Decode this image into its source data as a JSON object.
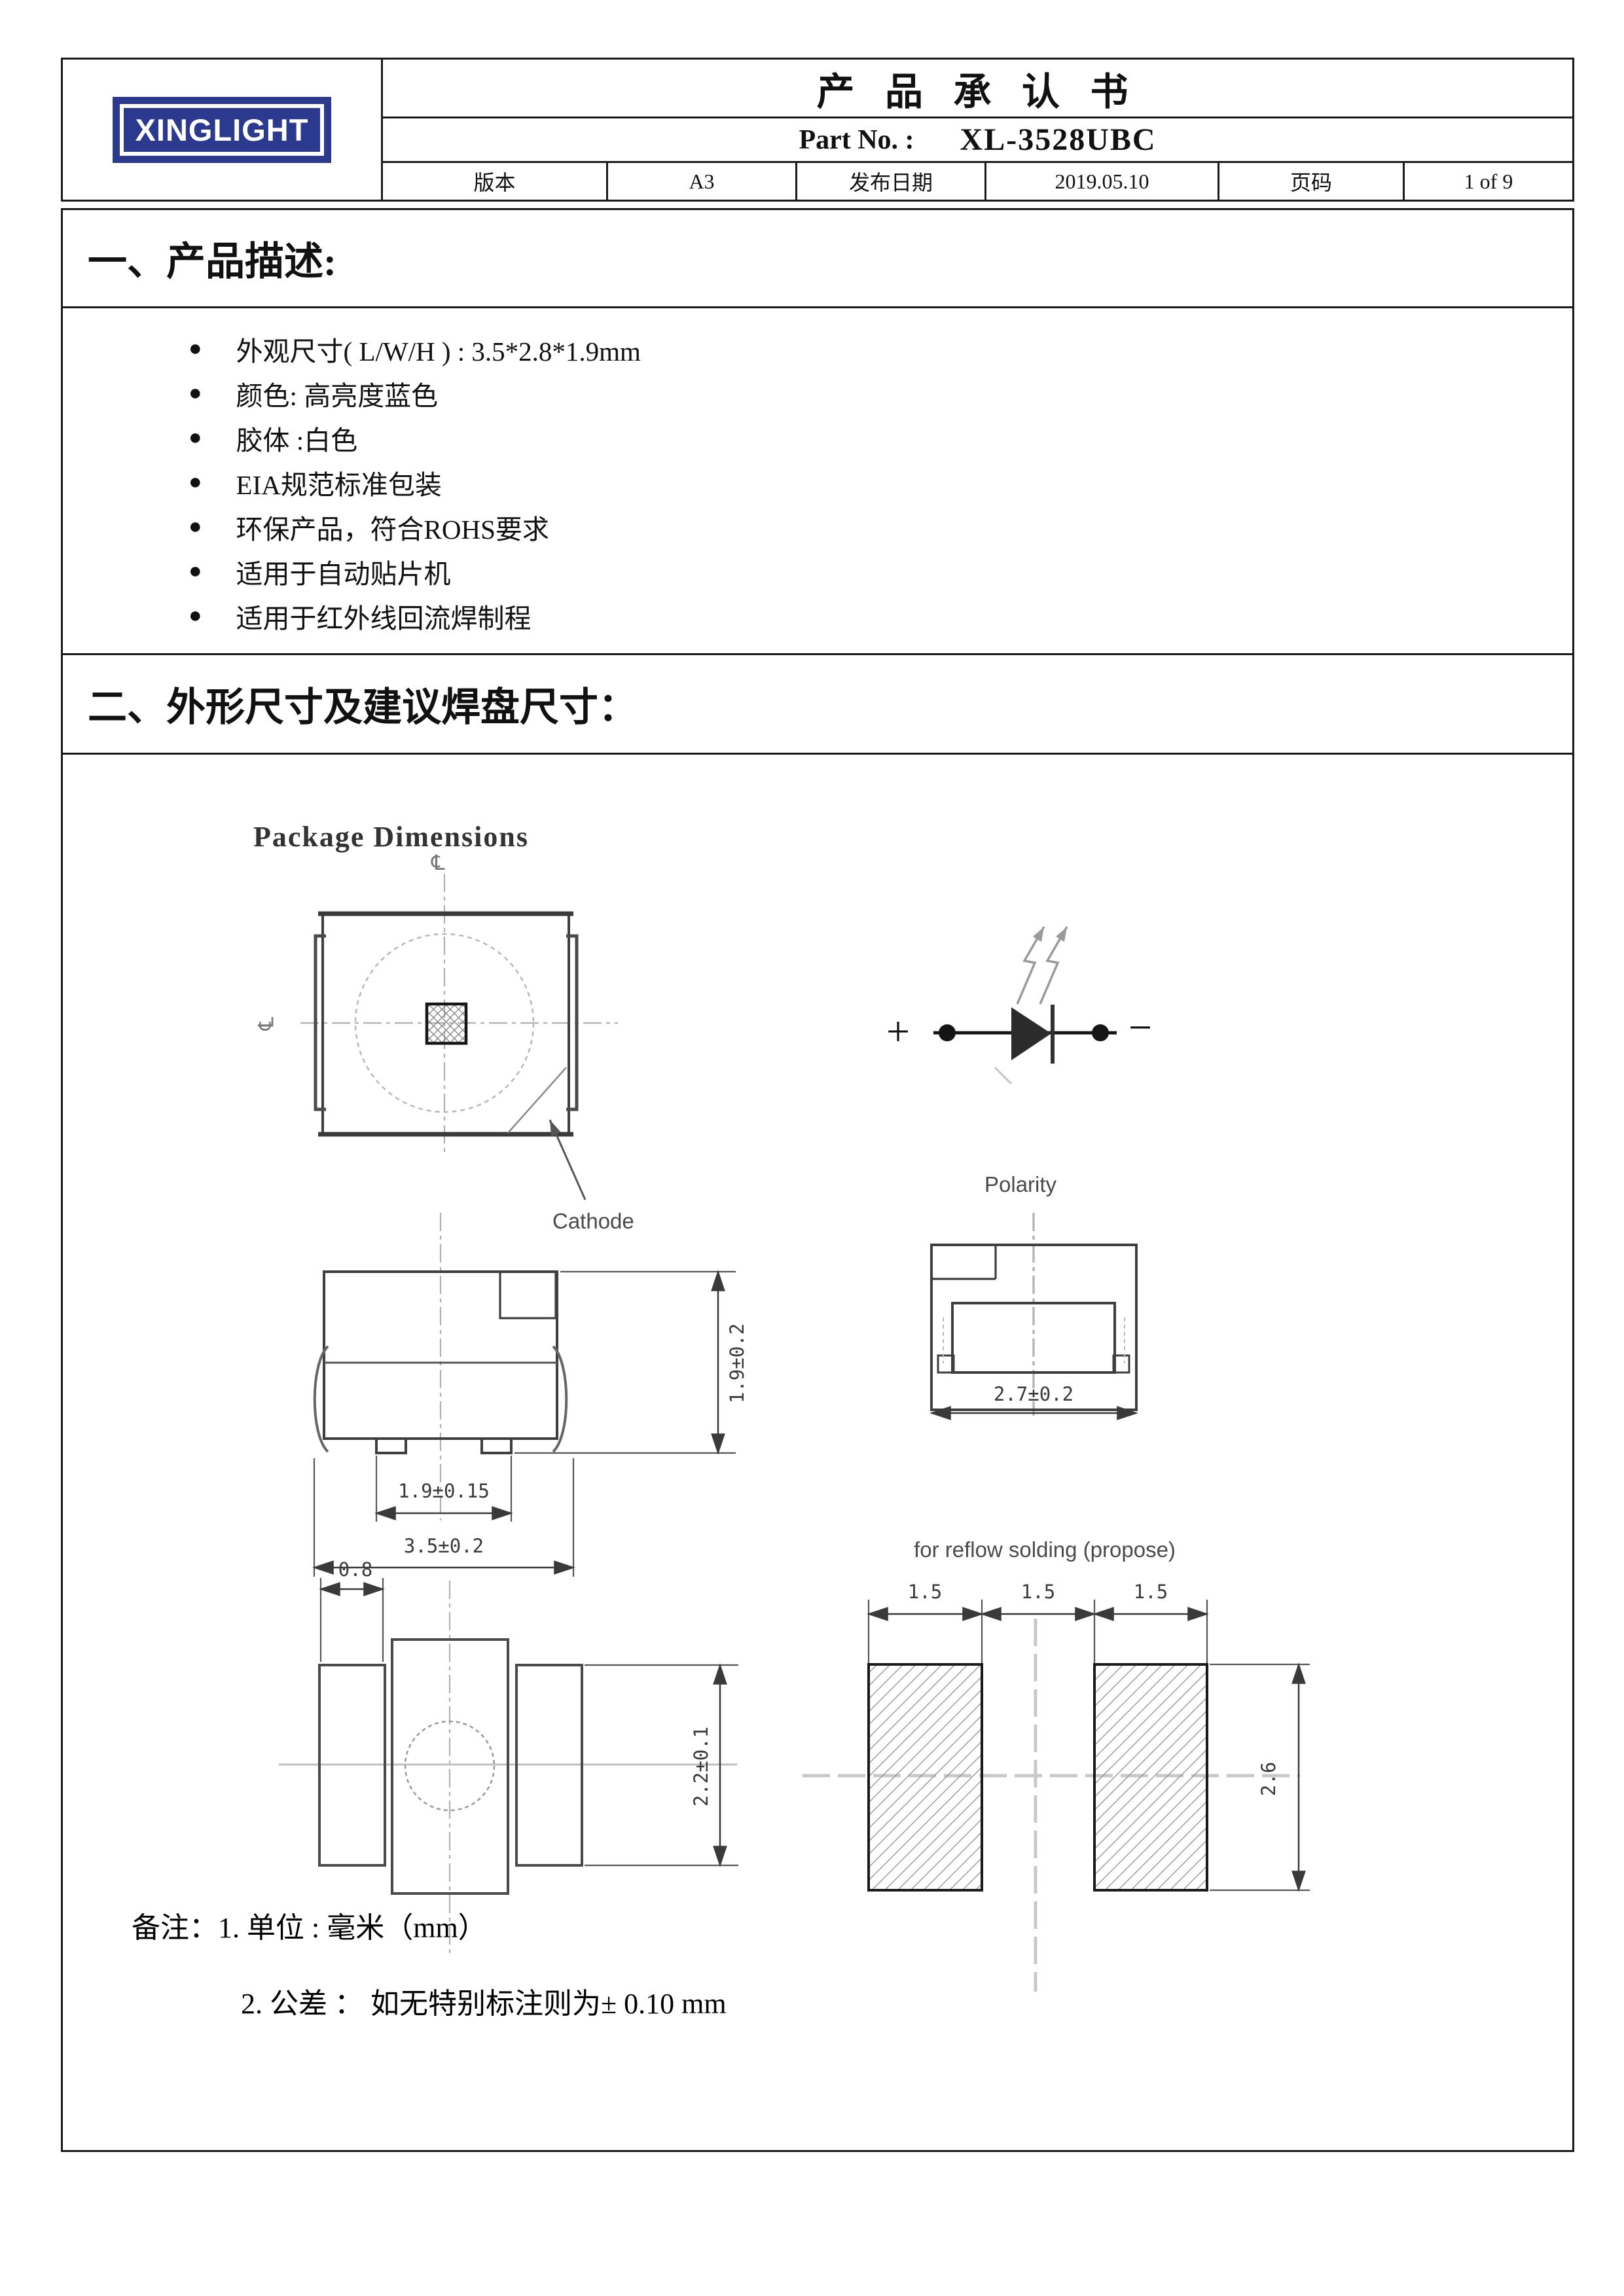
{
  "header": {
    "logo_text": "XINGLIGHT",
    "title": "产 品 承 认 书",
    "part_no_label": "Part No. :",
    "part_no_value": "XL-3528UBC",
    "fields": [
      {
        "label": "版本",
        "value": "A3"
      },
      {
        "label": "发布日期",
        "value": "2019.05.10"
      },
      {
        "label": "页码",
        "value": "1 of 9"
      }
    ]
  },
  "section1": {
    "heading": "一、产品描述:",
    "bullet_marker": "●",
    "bullets": [
      "外观尺寸( L/W/H ) :  3.5*2.8*1.9mm",
      "颜色: 高亮度蓝色",
      "胶体 :白色",
      "EIA规范标准包装",
      "环保产品，符合ROHS要求",
      "适用于自动贴片机",
      "适用于红外线回流焊制程"
    ]
  },
  "section2": {
    "heading": "二、外形尺寸及建议焊盘尺寸：",
    "drawing": {
      "title": "Package Dimensions",
      "centerline_symbol": "℄",
      "cathode_label": "Cathode",
      "polarity_plus": "+",
      "polarity_minus": "−",
      "polarity_label": "Polarity",
      "dims": {
        "side_height": "1.9±0.2",
        "side_inner_width": "1.9±0.15",
        "side_width": "3.5±0.2",
        "end_width": "2.7±0.2",
        "bottom_pad_width": "0.8",
        "bottom_pad_height": "2.2±0.1",
        "reflow_title": "for reflow solding (propose)",
        "reflow_left": "1.5",
        "reflow_center": "1.5",
        "reflow_right": "1.5",
        "reflow_height": "2.6"
      }
    },
    "notes": {
      "line1": "备注：1. 单位 : 毫米（mm）",
      "line2": "2. 公差 ： 如无特别标注则为± 0.10 mm"
    }
  },
  "colors": {
    "logo_blue": "#2b3a8e",
    "line_dark": "#3a3a3a",
    "centerline_gray": "#b0b0b0"
  }
}
